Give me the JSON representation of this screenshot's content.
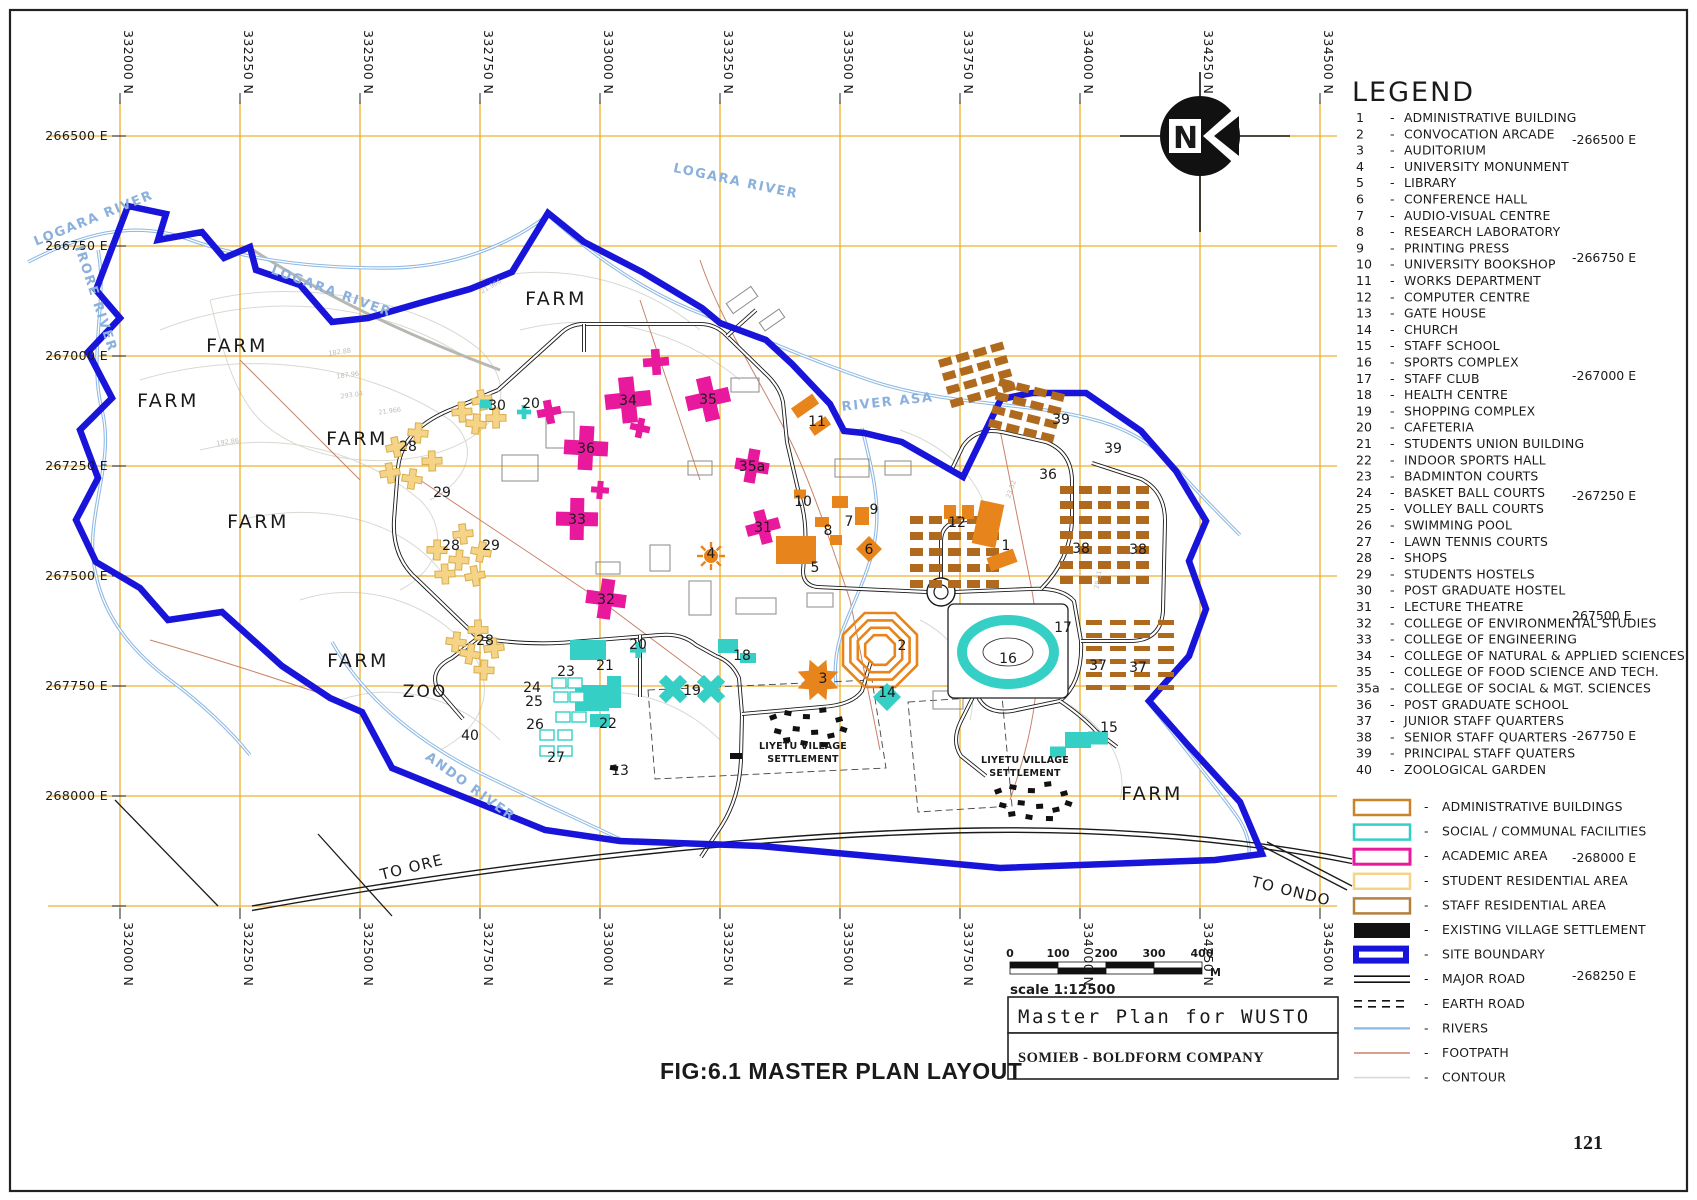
{
  "page": {
    "number": "121",
    "caption": "FIG:6.1 MASTER PLAN LAYOUT"
  },
  "title_block": {
    "title": "Master Plan for WUSTO",
    "company": "SOMIEB - BOLDFORM COMPANY"
  },
  "scale_bar": {
    "ticks": [
      "0",
      "100",
      "200",
      "300",
      "400"
    ],
    "unit": "M",
    "label": "scale 1:12500"
  },
  "compass": {
    "letter": "N"
  },
  "grid": {
    "north_labels": [
      "332000 N",
      "332250 N",
      "332500 N",
      "332750 N",
      "333000 N",
      "333250 N",
      "333500 N",
      "333750 N",
      "334000 N",
      "334250 N",
      "334500 N"
    ],
    "east_labels": [
      "266500 E",
      "266750 E",
      "267000 E",
      "267250 E",
      "267500 E",
      "267750 E",
      "268000 E"
    ],
    "right_east_labels": [
      {
        "t": "-266500 E",
        "y": 144
      },
      {
        "t": "-266750 E",
        "y": 262
      },
      {
        "t": "-267000 E",
        "y": 380
      },
      {
        "t": "-267250 E",
        "y": 500
      },
      {
        "t": "267500 E",
        "y": 620
      },
      {
        "t": "-267750 E",
        "y": 740
      },
      {
        "t": "-268000 E",
        "y": 862
      },
      {
        "t": "-268250 E",
        "y": 980
      }
    ]
  },
  "legend": {
    "title": "LEGEND",
    "items": [
      {
        "n": "1",
        "label": "ADMINISTRATIVE BUILDING"
      },
      {
        "n": "2",
        "label": "CONVOCATION ARCADE"
      },
      {
        "n": "3",
        "label": "AUDITORIUM"
      },
      {
        "n": "4",
        "label": "UNIVERSITY MONUNMENT"
      },
      {
        "n": "5",
        "label": "LIBRARY"
      },
      {
        "n": "6",
        "label": "CONFERENCE HALL"
      },
      {
        "n": "7",
        "label": "AUDIO-VISUAL CENTRE"
      },
      {
        "n": "8",
        "label": "RESEARCH LABORATORY"
      },
      {
        "n": "9",
        "label": "PRINTING PRESS"
      },
      {
        "n": "10",
        "label": "UNIVERSITY BOOKSHOP"
      },
      {
        "n": "11",
        "label": "WORKS DEPARTMENT"
      },
      {
        "n": "12",
        "label": "COMPUTER CENTRE"
      },
      {
        "n": "13",
        "label": "GATE HOUSE"
      },
      {
        "n": "14",
        "label": "CHURCH"
      },
      {
        "n": "15",
        "label": "STAFF SCHOOL"
      },
      {
        "n": "16",
        "label": "SPORTS COMPLEX"
      },
      {
        "n": "17",
        "label": "STAFF CLUB"
      },
      {
        "n": "18",
        "label": "HEALTH CENTRE"
      },
      {
        "n": "19",
        "label": "SHOPPING COMPLEX"
      },
      {
        "n": "20",
        "label": "CAFETERIA"
      },
      {
        "n": "21",
        "label": "STUDENTS UNION BUILDING"
      },
      {
        "n": "22",
        "label": "INDOOR SPORTS HALL"
      },
      {
        "n": "23",
        "label": "BADMINTON COURTS"
      },
      {
        "n": "24",
        "label": "BASKET BALL COURTS"
      },
      {
        "n": "25",
        "label": "VOLLEY BALL COURTS"
      },
      {
        "n": "26",
        "label": "SWIMMING POOL"
      },
      {
        "n": "27",
        "label": "LAWN TENNIS COURTS"
      },
      {
        "n": "28",
        "label": "SHOPS"
      },
      {
        "n": "29",
        "label": "STUDENTS HOSTELS"
      },
      {
        "n": "30",
        "label": "POST GRADUATE HOSTEL"
      },
      {
        "n": "31",
        "label": "LECTURE THEATRE"
      },
      {
        "n": "32",
        "label": "COLLEGE OF ENVIRONMENTAL STUDIES"
      },
      {
        "n": "33",
        "label": "COLLEGE OF ENGINEERING"
      },
      {
        "n": "34",
        "label": "COLLEGE OF NATURAL & APPLIED SCIENCES"
      },
      {
        "n": "35",
        "label": "COLLEGE OF FOOD SCIENCE AND TECH."
      },
      {
        "n": "35a",
        "label": "COLLEGE OF SOCIAL & MGT. SCIENCES"
      },
      {
        "n": "36",
        "label": "POST GRADUATE SCHOOL"
      },
      {
        "n": "37",
        "label": "JUNIOR STAFF QUARTERS"
      },
      {
        "n": "38",
        "label": "SENIOR STAFF QUARTERS"
      },
      {
        "n": "39",
        "label": "PRINCIPAL STAFF QUATERS"
      },
      {
        "n": "40",
        "label": "ZOOLOGICAL GARDEN"
      }
    ],
    "symbols": [
      {
        "label": "ADMINISTRATIVE BUILDINGS",
        "type": "admin"
      },
      {
        "label": "SOCIAL / COMMUNAL FACILITIES",
        "type": "social"
      },
      {
        "label": "ACADEMIC AREA",
        "type": "academic"
      },
      {
        "label": "STUDENT RESIDENTIAL AREA",
        "type": "student"
      },
      {
        "label": "STAFF RESIDENTIAL AREA",
        "type": "staff"
      },
      {
        "label": "EXISTING VILLAGE SETTLEMENT",
        "type": "village"
      },
      {
        "label": "SITE BOUNDARY",
        "type": "boundary"
      },
      {
        "label": "MAJOR ROAD",
        "type": "major-road"
      },
      {
        "label": "EARTH ROAD",
        "type": "earth-road"
      },
      {
        "label": "RIVERS",
        "type": "river"
      },
      {
        "label": "FOOTPATH",
        "type": "footpath"
      },
      {
        "label": "CONTOUR",
        "type": "contour"
      }
    ]
  },
  "colors": {
    "grid": "#EDB02E",
    "boundary": "#1814D9",
    "river": "#8CB8E4",
    "academic": "#E8199C",
    "admin": "#E8841C",
    "social": "#36CFC5",
    "student_fill": "#F5D488",
    "student_stroke": "#D8AE4C",
    "staff": "#B06A1E",
    "footpath": "#C8826A",
    "contour": "#D9D9D2",
    "scale_text": "#3A1FC0",
    "village": "#111111"
  },
  "map": {
    "area_labels": [
      {
        "t": "FARM",
        "x": 237,
        "y": 352
      },
      {
        "t": "FARM",
        "x": 168,
        "y": 407
      },
      {
        "t": "FARM",
        "x": 357,
        "y": 445
      },
      {
        "t": "FARM",
        "x": 556,
        "y": 305
      },
      {
        "t": "FARM",
        "x": 258,
        "y": 528
      },
      {
        "t": "FARM",
        "x": 358,
        "y": 667
      },
      {
        "t": "FARM",
        "x": 1152,
        "y": 800
      },
      {
        "t": "ZOO",
        "x": 425,
        "y": 697
      }
    ],
    "river_labels": [
      {
        "t": "LOGARA RIVER",
        "x": 95,
        "y": 222,
        "r": -22
      },
      {
        "t": "LOGARA RIVER",
        "x": 330,
        "y": 295,
        "r": 20
      },
      {
        "t": "LOGARA RIVER",
        "x": 735,
        "y": 185,
        "r": 12
      },
      {
        "t": "IRORE RIVER",
        "x": 92,
        "y": 300,
        "r": 72
      },
      {
        "t": "RIVER ASA",
        "x": 888,
        "y": 406,
        "r": -6
      },
      {
        "t": "ANDO RIVER",
        "x": 468,
        "y": 790,
        "r": 36
      }
    ],
    "road_labels": [
      {
        "t": "TO ORE",
        "x": 413,
        "y": 872,
        "r": -14
      },
      {
        "t": "TO ONDO",
        "x": 1290,
        "y": 896,
        "r": 14
      }
    ],
    "settlement_label": [
      "LIYETU VILLAGE",
      "SETTLEMENT"
    ],
    "settlements": [
      {
        "x": 803,
        "y": 749
      },
      {
        "x": 1025,
        "y": 763
      }
    ],
    "contour_labels": [
      {
        "t": "182.88",
        "x": 340,
        "y": 354,
        "r": -8
      },
      {
        "t": "187.96",
        "x": 348,
        "y": 377,
        "r": -8
      },
      {
        "t": "293.04",
        "x": 352,
        "y": 397,
        "r": -8
      },
      {
        "t": "21.966",
        "x": 390,
        "y": 413,
        "r": -8
      },
      {
        "t": "192.86",
        "x": 228,
        "y": 444,
        "r": -8
      },
      {
        "t": "21.966",
        "x": 492,
        "y": 288,
        "r": -30
      },
      {
        "t": "23.52",
        "x": 1013,
        "y": 490,
        "r": -70
      },
      {
        "t": "29.51",
        "x": 1100,
        "y": 580,
        "r": -80
      }
    ],
    "markers": [
      {
        "n": "1",
        "x": 1006,
        "y": 545,
        "c": "admin",
        "g": "none",
        "fs": 16
      },
      {
        "n": "2",
        "x": 902,
        "y": 645,
        "c": "admin",
        "g": "none",
        "fs": 20
      },
      {
        "n": "3",
        "x": 823,
        "y": 678,
        "c": "admin",
        "g": "none",
        "fs": 18
      },
      {
        "n": "4",
        "x": 711,
        "y": 553,
        "c": "admin",
        "g": "none",
        "fs": 15
      },
      {
        "n": "5",
        "x": 815,
        "y": 567,
        "c": "admin",
        "g": "none",
        "fs": 16
      },
      {
        "n": "6",
        "x": 869,
        "y": 549,
        "c": "admin",
        "g": "none",
        "fs": 15
      },
      {
        "n": "7",
        "x": 849,
        "y": 521,
        "c": "admin",
        "g": "none",
        "fs": 13
      },
      {
        "n": "8",
        "x": 828,
        "y": 530,
        "c": "admin",
        "g": "none",
        "fs": 14
      },
      {
        "n": "9",
        "x": 874,
        "y": 509,
        "c": "admin",
        "g": "none",
        "fs": 14
      },
      {
        "n": "10",
        "x": 803,
        "y": 501,
        "c": "admin",
        "g": "none",
        "fs": 13
      },
      {
        "n": "11",
        "x": 817,
        "y": 421,
        "c": "admin",
        "g": "none",
        "fs": 13
      },
      {
        "n": "12",
        "x": 957,
        "y": 522,
        "c": "admin",
        "g": "none",
        "fs": 14
      },
      {
        "n": "13",
        "x": 620,
        "y": 770,
        "c": "admin",
        "g": "none",
        "fs": 11
      },
      {
        "n": "14",
        "x": 887,
        "y": 692,
        "c": "social",
        "g": "none",
        "fs": 14
      },
      {
        "n": "15",
        "x": 1109,
        "y": 727,
        "c": "social",
        "g": "none",
        "fs": 15
      },
      {
        "n": "16",
        "x": 1008,
        "y": 658,
        "c": "social",
        "g": "none",
        "fs": 20
      },
      {
        "n": "17",
        "x": 1063,
        "y": 627,
        "c": "social",
        "g": "none",
        "fs": 14
      },
      {
        "n": "18",
        "x": 742,
        "y": 655,
        "c": "social",
        "g": "none",
        "fs": 14
      },
      {
        "n": "19",
        "x": 692,
        "y": 690,
        "c": "social",
        "g": "none",
        "fs": 15
      },
      {
        "n": "20",
        "x": 638,
        "y": 644,
        "c": "social",
        "g": "none",
        "fs": 14
      },
      {
        "n": "20",
        "x": 531,
        "y": 403,
        "c": "social",
        "g": "none",
        "fs": 13
      },
      {
        "n": "21",
        "x": 605,
        "y": 665,
        "c": "social",
        "g": "none",
        "fs": 15
      },
      {
        "n": "22",
        "x": 608,
        "y": 723,
        "c": "social",
        "g": "none",
        "fs": 15
      },
      {
        "n": "23",
        "x": 566,
        "y": 671,
        "c": "social",
        "g": "none",
        "fs": 13
      },
      {
        "n": "24",
        "x": 532,
        "y": 687,
        "c": "social",
        "g": "none",
        "fs": 13
      },
      {
        "n": "25",
        "x": 534,
        "y": 701,
        "c": "social",
        "g": "none",
        "fs": 13
      },
      {
        "n": "26",
        "x": 535,
        "y": 724,
        "c": "social",
        "g": "none",
        "fs": 13
      },
      {
        "n": "27",
        "x": 556,
        "y": 757,
        "c": "social",
        "g": "none",
        "fs": 13
      },
      {
        "n": "28",
        "x": 408,
        "y": 446,
        "c": "student",
        "g": "none",
        "fs": 14
      },
      {
        "n": "29",
        "x": 442,
        "y": 492,
        "c": "student",
        "g": "none",
        "fs": 14
      },
      {
        "n": "28",
        "x": 451,
        "y": 545,
        "c": "student",
        "g": "none",
        "fs": 14
      },
      {
        "n": "29",
        "x": 491,
        "y": 545,
        "c": "student",
        "g": "none",
        "fs": 14
      },
      {
        "n": "28",
        "x": 485,
        "y": 640,
        "c": "student",
        "g": "none",
        "fs": 14
      },
      {
        "n": "30",
        "x": 497,
        "y": 405,
        "c": "student",
        "g": "none",
        "fs": 14
      },
      {
        "n": "31",
        "x": 763,
        "y": 527,
        "c": "academic",
        "g": "none",
        "fs": 15
      },
      {
        "n": "32",
        "x": 606,
        "y": 599,
        "c": "academic",
        "g": "none",
        "fs": 16
      },
      {
        "n": "33",
        "x": 577,
        "y": 519,
        "c": "academic",
        "g": "none",
        "fs": 16
      },
      {
        "n": "34",
        "x": 628,
        "y": 400,
        "c": "academic",
        "g": "none",
        "fs": 16
      },
      {
        "n": "35",
        "x": 708,
        "y": 399,
        "c": "academic",
        "g": "none",
        "fs": 16
      },
      {
        "n": "35a",
        "x": 752,
        "y": 466,
        "c": "academic",
        "g": "none",
        "fs": 13
      },
      {
        "n": "36",
        "x": 586,
        "y": 448,
        "c": "academic",
        "g": "none",
        "fs": 15
      },
      {
        "n": "36",
        "x": 1048,
        "y": 474,
        "c": "staff",
        "g": "none",
        "fs": 15
      },
      {
        "n": "37",
        "x": 1098,
        "y": 665,
        "c": "staff",
        "g": "none",
        "fs": 15
      },
      {
        "n": "37",
        "x": 1138,
        "y": 667,
        "c": "staff",
        "g": "none",
        "fs": 15
      },
      {
        "n": "38",
        "x": 1081,
        "y": 548,
        "c": "staff",
        "g": "none",
        "fs": 15
      },
      {
        "n": "38",
        "x": 1138,
        "y": 549,
        "c": "staff",
        "g": "none",
        "fs": 15
      },
      {
        "n": "39",
        "x": 1061,
        "y": 419,
        "c": "staff",
        "g": "none",
        "fs": 15
      },
      {
        "n": "39",
        "x": 1113,
        "y": 448,
        "c": "staff",
        "g": "none",
        "fs": 15
      },
      {
        "n": "40",
        "x": 470,
        "y": 735,
        "c": "other",
        "g": "none",
        "fs": 15
      }
    ]
  }
}
